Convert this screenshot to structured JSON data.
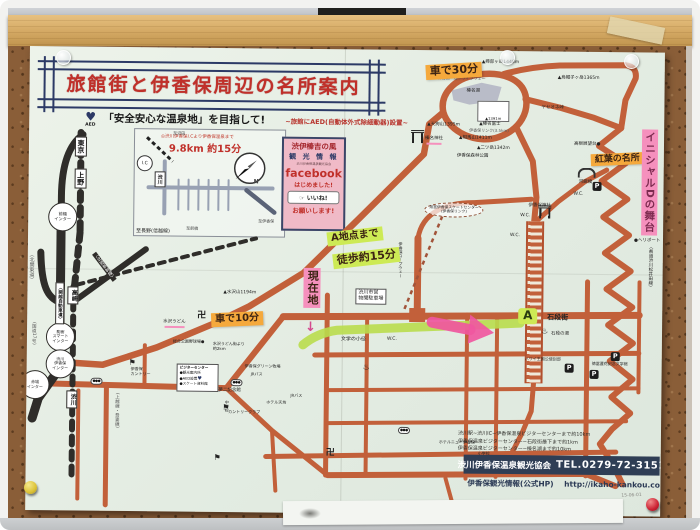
{
  "poster": {
    "title": "旅館街と伊香保周辺の名所案内",
    "subtitle": "「安全安心な温泉地」を目指して!",
    "subtitle_note": "~旅館にAED(自動体外式除細動器)設置~",
    "aed_label": "AED",
    "inset": {
      "line1": "◎渋川伊香保I.Cより伊香保温泉まで",
      "line2": "9.8km 約15分",
      "station": "渋川",
      "ic": "I.C",
      "compass_n": "N",
      "to_numata": "至沼田",
      "to_ikaho": "至伊香保",
      "to_maebashi": "至前橋"
    },
    "facebook": {
      "line1": "渋伊榛吉の風",
      "line2": "観 光 情 報",
      "line3": "渋川伊香保温泉観光協会",
      "word": "facebook",
      "line4": "はじめました!",
      "like": "いいね!",
      "line5": "お願いします!"
    },
    "legend": {
      "title": "ビジターセンター",
      "item1": "●観光案内所",
      "item2": "●AED設置",
      "item3": "●スケート資料館"
    },
    "footer": {
      "dist1": "渋川駅~渋川IC~伊香保温泉ビジターセンターまで約10km",
      "dist2": "伊香保温泉ビジターセンター~石段街最下まで約1km",
      "dist3": "伊香保温泉ビジターセンター~榛名湖まで約10km",
      "org": "渋川伊香保温泉観光協会",
      "tel": "TEL.0279-72-3151",
      "hp": "伊香保観光情報(公式HP)",
      "url": "http://ikaho-kankou.com/",
      "date": "15-06-01"
    }
  },
  "colors": {
    "road_orange": "#c2603a",
    "road_black": "#2f2d2a",
    "highlight_orange": "#f5a93c",
    "highlight_green": "#cdea55",
    "highlight_pink": "#f590bd",
    "route_green": "#b9dd4e",
    "arrow_pink": "#f0579f",
    "title_red": "#c0302a",
    "banner_navy": "#2c3a66",
    "footer_navy": "#2f3e55",
    "cork_brown": "#8a5e38"
  },
  "map": {
    "labels": [
      {
        "n": "ann-car-30min",
        "t": "車で30分",
        "x": 396,
        "y": 13,
        "s": 11,
        "c": "hw bg-o",
        "r": -4
      },
      {
        "n": "ann-a-chiten",
        "t": "A地点まで",
        "x": 299,
        "y": 180,
        "s": 10,
        "c": "hw bg-g",
        "r": -7
      },
      {
        "n": "ann-toho-15min",
        "t": "徒歩約15分",
        "x": 305,
        "y": 201,
        "s": 11,
        "c": "hw bg-g",
        "r": -7
      },
      {
        "n": "ann-genzaichi",
        "t": "現在地",
        "x": 276,
        "y": 219,
        "s": 11,
        "c": "hw bg-p vtext"
      },
      {
        "n": "ann-down-arrow",
        "t": "↓",
        "x": 278,
        "y": 272,
        "s": 13,
        "c": "hw pink-ink"
      },
      {
        "n": "ann-car-10min",
        "t": "車で10分",
        "x": 184,
        "y": 264,
        "s": 10,
        "c": "hw bg-o",
        "r": -3
      },
      {
        "n": "ann-koyo-meisho",
        "t": "紅葉の名所",
        "x": 562,
        "y": 101,
        "s": 9,
        "c": "hw bg-o",
        "r": -3
      },
      {
        "n": "ann-initial-d",
        "t": "イニシャルDの舞台",
        "x": 613,
        "y": 77,
        "s": 10.5,
        "c": "hw bg-p vtext ink-purple"
      },
      {
        "n": "ann-point-a",
        "t": "A",
        "x": 491,
        "y": 257,
        "s": 12,
        "c": "hw bg-g abox"
      },
      {
        "t": "東京",
        "x": 46,
        "y": 90,
        "s": 7,
        "c": "vbox"
      },
      {
        "t": "上野",
        "x": 46,
        "y": 122,
        "s": 7,
        "c": "vbox"
      },
      {
        "t": "前橋\nインター",
        "x": 20,
        "y": 156,
        "s": 4.2,
        "c": "circle"
      },
      {
        "t": "駒寄\nスマート\nインター",
        "x": 19,
        "y": 276,
        "s": 4,
        "c": "circle"
      },
      {
        "t": "渋川\n伊香保\nインター",
        "x": 19,
        "y": 303,
        "s": 4,
        "c": "circle"
      },
      {
        "t": "赤城\nインター",
        "x": -6,
        "y": 324,
        "s": 4,
        "c": "circle"
      },
      {
        "t": "〈北関東道〉",
        "x": 0,
        "y": 206,
        "s": 5,
        "c": "v gray"
      },
      {
        "t": "〈関越自動車道〉",
        "x": 28,
        "y": 236,
        "s": 4.5,
        "c": "vbox"
      },
      {
        "t": "(国道17号)",
        "x": 4,
        "y": 276,
        "s": 4.5,
        "c": "v gray"
      },
      {
        "t": "〈北陸新幹線〉",
        "x": 74,
        "y": 203,
        "s": 4.5,
        "c": "wonblack",
        "r": -38
      },
      {
        "t": "至長野(信越線)",
        "x": 108,
        "y": 182,
        "s": 5
      },
      {
        "t": "高崎",
        "x": 40,
        "y": 240,
        "s": 6,
        "c": "vbox"
      },
      {
        "t": "渋川",
        "x": 40,
        "y": 344,
        "s": 6,
        "c": "vbox"
      },
      {
        "t": "(上越線・吾妻線)",
        "x": 88,
        "y": 346,
        "s": 4.5,
        "c": "v gray"
      },
      {
        "t": "▲天狗山1395m",
        "x": 398,
        "y": 72,
        "s": 4.5
      },
      {
        "t": "▲掃部ヶ岳1448m",
        "x": 452,
        "y": 9,
        "s": 4.5
      },
      {
        "t": "▲烏帽子ヶ岳1365m",
        "x": 528,
        "y": 24,
        "s": 4.5
      },
      {
        "t": "▲相馬山1411m",
        "x": 430,
        "y": 85,
        "s": 4.5
      },
      {
        "t": "▲二ツ岳1342m",
        "x": 448,
        "y": 95,
        "s": 4.5
      },
      {
        "t": "▲水沢山1194m",
        "x": 196,
        "y": 242,
        "s": 4.5
      },
      {
        "t": "榛名湖",
        "x": 437,
        "y": 38,
        "s": 4.5
      },
      {
        "t": "榛名湖一周ドライブウェー",
        "x": 408,
        "y": 26,
        "s": 4,
        "c": "gray"
      },
      {
        "t": "▲1391m",
        "x": 448,
        "y": 50,
        "s": 3.8,
        "c": "fujibox"
      },
      {
        "t": "▲榛名富士",
        "x": 450,
        "y": 71,
        "s": 4.5
      },
      {
        "t": "ヤセオネ峠",
        "x": 512,
        "y": 54,
        "s": 4.5
      },
      {
        "t": "伊香保森林公園",
        "x": 428,
        "y": 103,
        "s": 4.5
      },
      {
        "t": "伊香保リンク(3.5km)",
        "x": 440,
        "y": 78,
        "s": 4,
        "c": "gray"
      },
      {
        "t": "高根展望台●",
        "x": 545,
        "y": 90,
        "s": 4.5
      },
      {
        "t": "榛名神社",
        "x": 396,
        "y": 86,
        "s": 4.5,
        "c": "pinkbar"
      },
      {
        "t": "河鹿橋",
        "x": 550,
        "y": 128,
        "s": 4.5
      },
      {
        "t": "●ヘリポート",
        "x": 606,
        "y": 186,
        "s": 4.5
      },
      {
        "t": "〈県道渋川松井田線〉",
        "x": 620,
        "y": 192,
        "s": 4.5,
        "c": "v"
      },
      {
        "t": "伊香保神社",
        "x": 500,
        "y": 152,
        "s": 4.5
      },
      {
        "t": "石段街",
        "x": 520,
        "y": 262,
        "s": 7,
        "c": "bold"
      },
      {
        "t": "石段の湯",
        "x": 524,
        "y": 280,
        "s": 4.5
      },
      {
        "t": "ハワイ王国公使別邸",
        "x": 498,
        "y": 306,
        "s": 4
      },
      {
        "t": "徳冨蘆花記念文学館",
        "x": 565,
        "y": 310,
        "s": 4
      },
      {
        "t": "文学の小径",
        "x": 314,
        "y": 288,
        "s": 5
      },
      {
        "t": "渋川市営\n物聞駐車場",
        "x": 328,
        "y": 239,
        "s": 5,
        "c": "wbox pre"
      },
      {
        "t": "伊香保ロープウェー",
        "x": 370,
        "y": 192,
        "s": 4,
        "c": "v"
      },
      {
        "t": "県営伊香保スケートセンター\n(伊香保リンク)",
        "x": 396,
        "y": 152,
        "s": 3.8,
        "c": "oval"
      },
      {
        "t": "夢二記念館",
        "x": 192,
        "y": 340,
        "s": 4.5
      },
      {
        "t": "JRバス",
        "x": 224,
        "y": 324,
        "s": 4
      },
      {
        "t": "JRバス",
        "x": 264,
        "y": 345,
        "s": 4
      },
      {
        "t": "中学校",
        "x": 198,
        "y": 352,
        "s": 4,
        "c": "v"
      },
      {
        "t": "ホテル天坊",
        "x": 240,
        "y": 352,
        "s": 4
      },
      {
        "t": "伊香保グリーン牧場",
        "x": 218,
        "y": 316,
        "s": 4
      },
      {
        "t": "総合公園野球場●",
        "x": 146,
        "y": 292,
        "s": 4
      },
      {
        "t": "水沢うどん街より\n約2km",
        "x": 186,
        "y": 294,
        "s": 4,
        "c": "pre"
      },
      {
        "t": "水沢うどん",
        "x": 136,
        "y": 272,
        "s": 4.5,
        "c": "pinkbar"
      },
      {
        "t": "伊香保\nカントリー",
        "x": 104,
        "y": 320,
        "s": 4,
        "c": "pre"
      },
      {
        "t": "カントリークラブ",
        "x": 202,
        "y": 362,
        "s": 4
      },
      {
        "t": "ホテルニュー伊香保",
        "x": 413,
        "y": 390,
        "s": 4
      },
      {
        "t": "小学校",
        "x": 452,
        "y": 401,
        "s": 4
      },
      {
        "t": "W.C.",
        "x": 492,
        "y": 162,
        "s": 4.5
      },
      {
        "t": "W.C.",
        "x": 482,
        "y": 182,
        "s": 4.5
      },
      {
        "t": "W.C.",
        "x": 360,
        "y": 287,
        "s": 4.5
      },
      {
        "t": "W.C.",
        "x": 545,
        "y": 140,
        "s": 4.5
      }
    ],
    "icons": [
      {
        "type": "torii",
        "x": 382,
        "y": 80
      },
      {
        "type": "torii",
        "x": 510,
        "y": 154
      },
      {
        "type": "manji",
        "x": 170,
        "y": 264
      },
      {
        "type": "manji",
        "x": 300,
        "y": 400
      },
      {
        "type": "onsen",
        "x": 514,
        "y": 276
      },
      {
        "type": "onsen",
        "x": 336,
        "y": 314
      },
      {
        "type": "golf",
        "x": 102,
        "y": 312
      },
      {
        "type": "golf",
        "x": 196,
        "y": 356
      },
      {
        "type": "golf",
        "x": 188,
        "y": 406
      },
      {
        "type": "p",
        "x": 564,
        "y": 130
      },
      {
        "type": "p",
        "x": 584,
        "y": 300
      },
      {
        "type": "p",
        "x": 538,
        "y": 312
      },
      {
        "type": "p",
        "x": 563,
        "y": 318
      },
      {
        "type": "bus",
        "x": 64,
        "y": 331
      },
      {
        "type": "bus",
        "x": 204,
        "y": 331
      },
      {
        "type": "bus",
        "x": 372,
        "y": 377
      },
      {
        "type": "bridge",
        "x": 549,
        "y": 116
      }
    ]
  }
}
